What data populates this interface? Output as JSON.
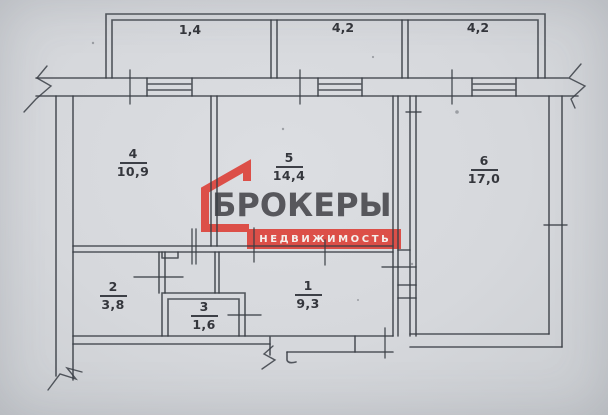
{
  "document": {
    "type": "apartment floor plan scan",
    "paper_color": "#d6d8dc",
    "ink_color": "#3a3e45"
  },
  "balconies": [
    {
      "id": "balcony-left",
      "area": "1,4"
    },
    {
      "id": "balcony-middle",
      "area": "4,2"
    },
    {
      "id": "balcony-right",
      "area": "4,2"
    }
  ],
  "rooms": [
    {
      "number": "1",
      "area": "9,3"
    },
    {
      "number": "2",
      "area": "3,8"
    },
    {
      "number": "3",
      "area": "1,6"
    },
    {
      "number": "4",
      "area": "10,9"
    },
    {
      "number": "5",
      "area": "14,4"
    },
    {
      "number": "6",
      "area": "17,0"
    }
  ],
  "watermark": {
    "brand": "БРОКЕРЫ",
    "tagline": "НЕДВИЖИМОСТЬ",
    "accent_color": "#dc4f48",
    "brand_text_color": "#57575c"
  }
}
